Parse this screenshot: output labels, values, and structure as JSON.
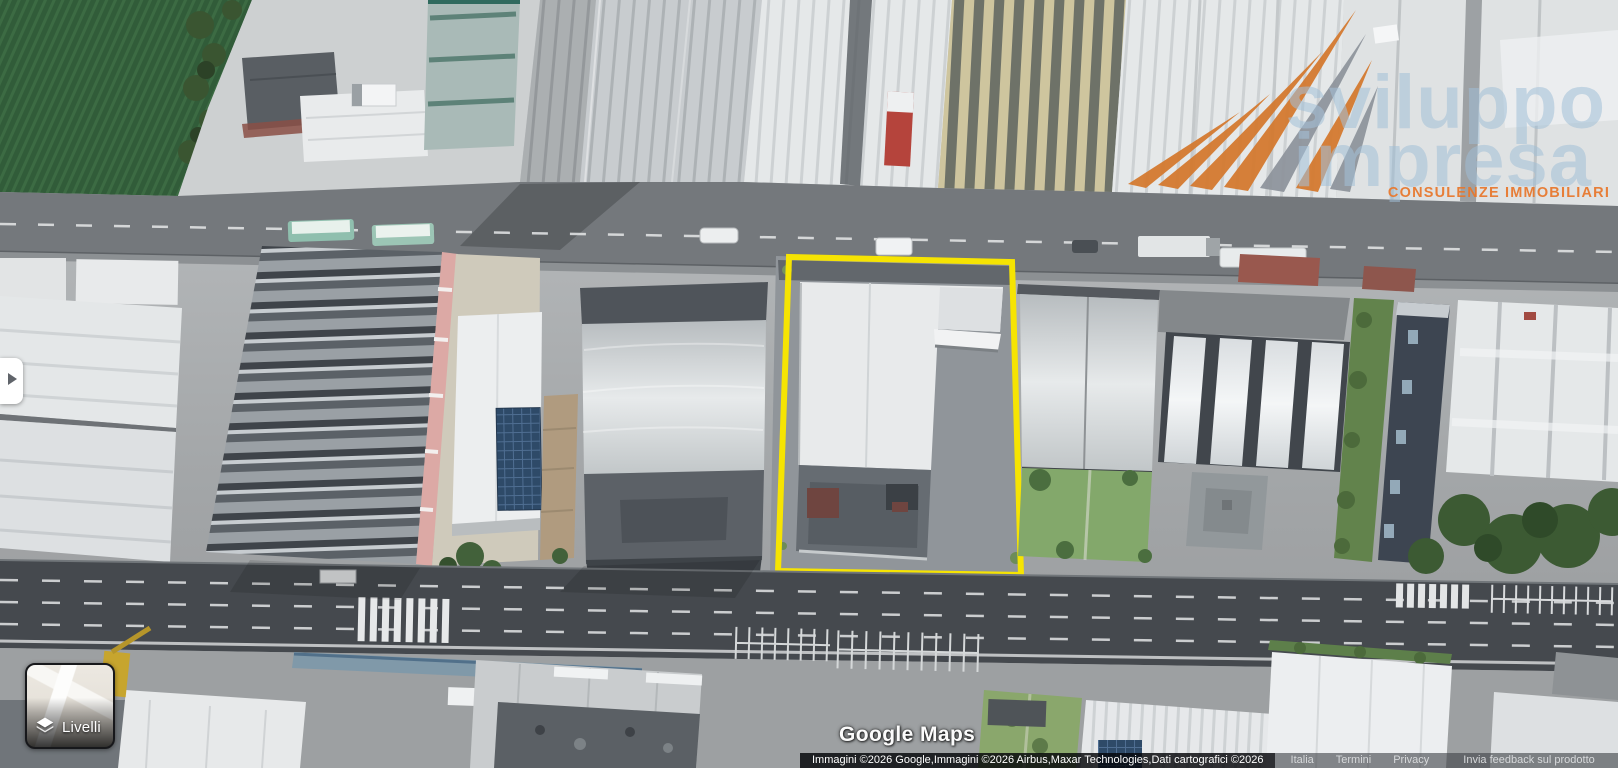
{
  "window": {
    "width": 1618,
    "height": 768
  },
  "map": {
    "view": "3d-satellite",
    "description": "Aerial 3D satellite view of an industrial district with a parcel highlighted",
    "highlight_color": "#F6E402"
  },
  "logo": {
    "word1": "sviluppo",
    "word2": "impresa",
    "tagline": "CONSULENZE IMMOBILIARI",
    "text_color": "#9FBDD6",
    "tagline_color": "#E8762A",
    "stripe_orange": "#D4772B",
    "stripe_gray": "#8D939B"
  },
  "side_panel_toggle": {
    "icon": "right-arrow"
  },
  "layers_button": {
    "label": "Livelli",
    "icon": "layers-diamond"
  },
  "watermark": {
    "text": "Google Maps"
  },
  "attribution": {
    "copyright": "Immagini ©2026 Google,Immagini ©2026 Airbus,Maxar Technologies,Dati cartografici ©2026",
    "links": [
      "Italia",
      "Termini",
      "Privacy",
      "Invia feedback sul prodotto"
    ]
  }
}
